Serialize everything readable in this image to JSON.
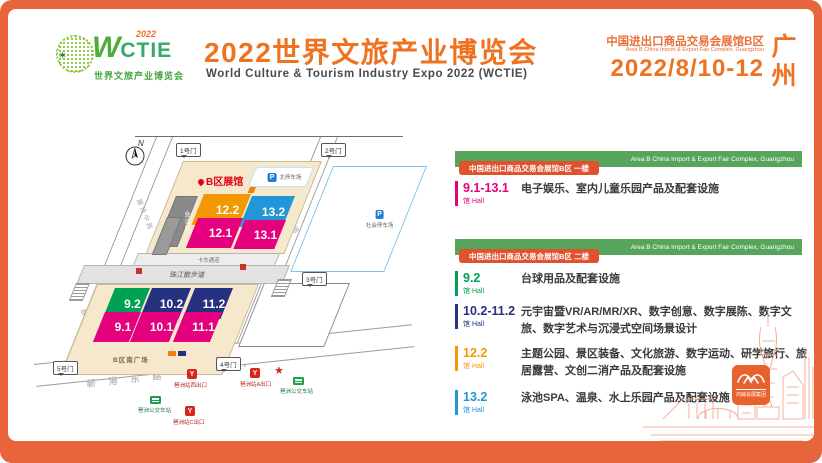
{
  "header": {
    "logo": {
      "acronym_w": "W",
      "acronym_rest": "CTIE",
      "year": "2022",
      "tagline": "世界文旅产业博览会",
      "star": "✶"
    },
    "title_cn": "2022世界文旅产业博览会",
    "title_en": "World Culture & Tourism Industry Expo 2022 (WCTIE)",
    "venue_cn": "中国进出口商品交易会展馆B区",
    "venue_en": "Area B China Import & Export Fair Complex, Guangzhou",
    "dates": "2022/8/10-12",
    "city": "广州"
  },
  "map": {
    "compass": "N",
    "area_label": "B区展馆",
    "gates": [
      {
        "label": "1号门"
      },
      {
        "label": "2号门"
      },
      {
        "label": "3号门"
      },
      {
        "label": "4号门"
      },
      {
        "label": "5号门"
      }
    ],
    "halls": [
      {
        "label": "12.2",
        "color": "#F39800"
      },
      {
        "label": "13.2",
        "color": "#2297D8"
      },
      {
        "label": "12.1",
        "color": "#E5007E"
      },
      {
        "label": "13.1",
        "color": "#E5007E"
      },
      {
        "label": "9.2",
        "color": "#00A152"
      },
      {
        "label": "10.2",
        "color": "#26317F"
      },
      {
        "label": "11.2",
        "color": "#26317F"
      },
      {
        "label": "9.1",
        "color": "#E5007E"
      },
      {
        "label": "10.1",
        "color": "#E5007E"
      },
      {
        "label": "11.1",
        "color": "#E5007E"
      }
    ],
    "conference_label": "会议区",
    "parking_symbol": "P",
    "parking_north": "北停车场",
    "parking_east": "社会停车场",
    "plaza": "B区南广场",
    "truck_lane": "卡车通道",
    "promenade": "珠江散步道",
    "roads": {
      "west": "展场中路",
      "east": "展场东路",
      "south": "新港东路"
    },
    "transit": [
      {
        "type": "metro",
        "label": "琶洲站西出口"
      },
      {
        "type": "metro",
        "label": "琶洲站A出口"
      },
      {
        "type": "bus",
        "label": "琶洲公交车站"
      },
      {
        "type": "bus",
        "label": "琶洲公交车站"
      },
      {
        "type": "metro",
        "label": "琶洲站C出口"
      }
    ]
  },
  "panel": {
    "hall_cn": "馆",
    "hall_en": "Hall",
    "sections": [
      {
        "banner_en": "Area B China Import & Export Fair Complex, Guangzhou",
        "tag": "中国进出口商品交易会展馆B区 一楼",
        "entries": [
          {
            "hall": "9.1-13.1",
            "color": "#E5007E",
            "desc": "电子娱乐、室内儿童乐园产品及配套设施"
          }
        ]
      },
      {
        "banner_en": "Area B China Import & Export Fair Complex, Guangzhou",
        "tag": "中国进出口商品交易会展馆B区 二楼",
        "entries": [
          {
            "hall": "9.2",
            "color": "#00A152",
            "desc": "台球用品及配套设施"
          },
          {
            "hall": "10.2-11.2",
            "color": "#26317F",
            "desc": "元宇宙暨VR/AR/MR/XR、数字创意、数字展陈、数字文旅、数字艺术与沉浸式空间场景设计"
          },
          {
            "hall": "12.2",
            "color": "#F39800",
            "desc": "主题公园、景区装备、文化旅游、数字运动、研学旅行、旅居露营、文创二消产品及配套设施"
          },
          {
            "hall": "13.2",
            "color": "#2297D8",
            "desc": "泳池SPA、温泉、水上乐园产品及配套设施"
          }
        ]
      }
    ]
  },
  "footer": {
    "organizer": "鸿威会展集团"
  },
  "colors": {
    "frame": "#E8643C",
    "title": "#EF7220",
    "banner_green": "#57A45B",
    "tag_red": "#E0512D",
    "magenta": "#E5007E",
    "navy": "#26317F",
    "blue": "#2297D8",
    "orange": "#F39800",
    "green": "#00A152",
    "beige": "#F6E8CD"
  }
}
